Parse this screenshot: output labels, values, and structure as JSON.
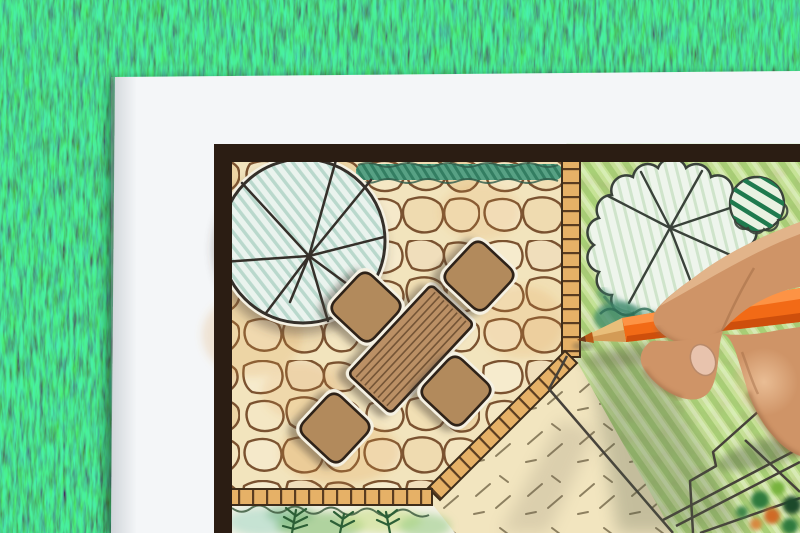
{
  "scene": {
    "description": "right hand holding an orange colored pencil, drawing a garden landscape plan on a white sheet lying on green grass",
    "background": {
      "name": "grass-lawn"
    },
    "paper": {
      "name": "white-drawing-sheet"
    },
    "plan": {
      "border": "dark plan frame",
      "areas": [
        "flagstone-patio",
        "top-hedge-strip",
        "round-tree-canopy-top-left",
        "garden-lawn-right",
        "scalloped-tree-canopy-right",
        "striped-shrub",
        "teal-shrub",
        "gravel-area-with-tick-marks",
        "planting-bed-with-ferns",
        "brick-tile-edging"
      ],
      "furniture": {
        "table": "rectangular wood-plank table",
        "chair_count": 4
      }
    },
    "hand": {
      "side": "right",
      "holding": "colored pencil"
    },
    "pencil": {
      "type": "colored-pencil",
      "color_name": "orange"
    }
  },
  "palette": {
    "grass": "#35622e",
    "paper": "#f4f6f8",
    "frame": "#2b1d13",
    "plan_base": "#efe4c2",
    "stone_bg": "#f2e4bd",
    "stone_line": "#7a5230",
    "hedge": "#57a184",
    "tile": "#e6b167",
    "tile_line": "#5a3c20",
    "lawn": "#cee09c",
    "pale_area": "#f2e5bf",
    "bed_base": "#f3f1e4",
    "table": "#bb9065",
    "chair": "#b28a5c",
    "ink": "#35302a",
    "outline": "#46413a",
    "pencil_body": "#f26a16",
    "pencil_wood": "#e9be7a",
    "skin": "#cf9467",
    "halo": "#f5f1e3"
  }
}
